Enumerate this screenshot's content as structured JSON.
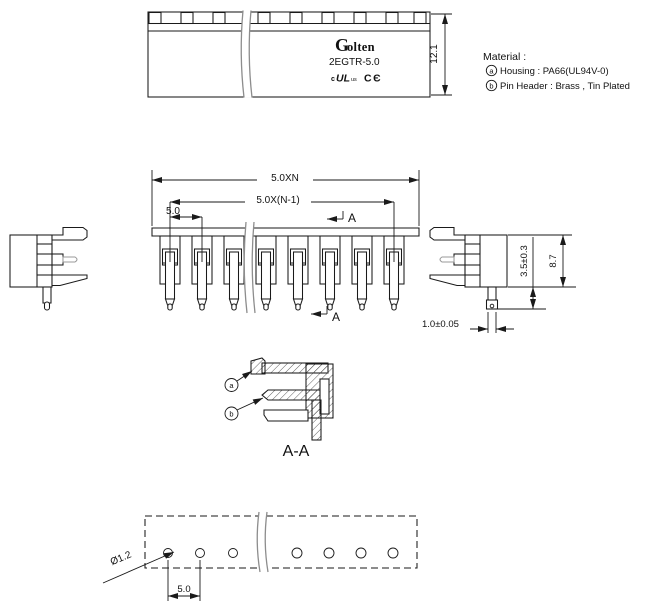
{
  "drawing": {
    "top_view": {
      "brand_initial": "G",
      "brand_rest": "olten",
      "model": "2EGTR-5.0",
      "ul_mark": {
        "pre": "c",
        "core": "UL",
        "post": "us"
      },
      "ce_mark": "CЄ",
      "dim_depth": "12.1"
    },
    "material_note": {
      "title": "Material :",
      "items": [
        {
          "key": "a",
          "text": "Housing : PA66(UL94V-0)"
        },
        {
          "key": "b",
          "text": "Pin Header : Brass , Tin Plated"
        }
      ]
    },
    "front_view": {
      "dim_total_width": "5.0XN",
      "dim_pin_span": "5.0X(N-1)",
      "dim_pitch": "5.0",
      "section_arrow_top": "A",
      "section_arrow_bottom": "A"
    },
    "side_view": {
      "dim_pin_length": "3.5±0.3",
      "dim_body_height": "8.7",
      "dim_pin_width": "1.0±0.05"
    },
    "section_view": {
      "label": "A-A",
      "callout_housing": "a",
      "callout_pin": "b"
    },
    "tape_view": {
      "dim_hole_diameter": "Ø1.2",
      "dim_hole_pitch": "5.0"
    }
  }
}
